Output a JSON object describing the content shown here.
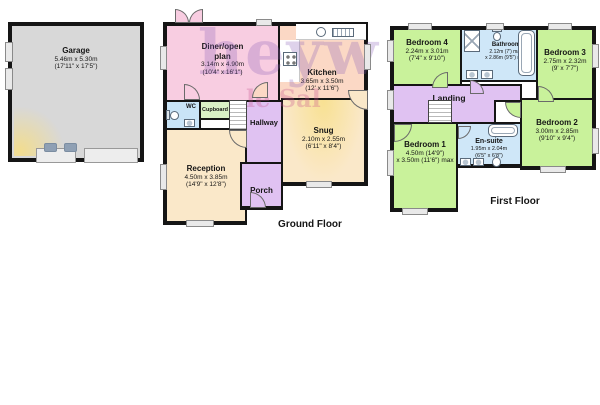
{
  "watermark": {
    "line1": "heyw",
    "line2": "le Sal"
  },
  "colors": {
    "wall": "#151515",
    "pink": "#f8cde1",
    "peach": "#fbd8c5",
    "cream": "#fae8c9",
    "purple": "#e0c2f2",
    "blue": "#cfe7f8",
    "wc_blue": "#c9e4f7",
    "green": "#c9f29b",
    "cupboard_green": "#d9f0c5",
    "garage_gray": "#d8d8d8",
    "watermark_purple": "rgba(138,92,182,0.28)",
    "watermark_pink": "rgba(199,82,143,0.30)"
  },
  "garage": {
    "name": "Garage",
    "dim_m": "5.46m x 5.30m",
    "dim_ft": "(17'11\" x 17'5\")"
  },
  "ground_floor": {
    "label": "Ground Floor",
    "rooms": {
      "diner": {
        "line1": "Diner/open",
        "line2": "plan",
        "dim_m": "3.14m x 4.90m",
        "dim_ft": "(10'4\" x 16'1\")"
      },
      "kitchen": {
        "name": "Kitchen",
        "dim_m": "3.65m x 3.50m",
        "dim_ft": "(12' x 11'6\")"
      },
      "wc": {
        "name": "WC"
      },
      "cupboard": {
        "name": "Cupboard"
      },
      "hallway": {
        "name": "Hallway"
      },
      "snug": {
        "name": "Snug",
        "dim_m": "2.10m x 2.55m",
        "dim_ft": "(6'11\" x 8'4\")"
      },
      "reception": {
        "name": "Reception",
        "dim_m": "4.50m x 3.85m",
        "dim_ft": "(14'9\" x 12'8\")"
      },
      "porch": {
        "name": "Porch"
      }
    }
  },
  "first_floor": {
    "label": "First Floor",
    "rooms": {
      "bedroom4": {
        "name": "Bedroom 4",
        "dim_m": "2.24m x 3.01m",
        "dim_ft": "(7'4\" x 9'10\")"
      },
      "bathroom": {
        "name": "Bathroom",
        "dim1": "2.12m (7') max",
        "dim2": "x 2.86m (9'5\") max"
      },
      "bedroom3": {
        "name": "Bedroom 3",
        "dim_m": "2.75m x 2.32m",
        "dim_ft": "(9' x 7'7\")"
      },
      "landing": {
        "name": "Landing"
      },
      "bedroom1": {
        "name": "Bedroom 1",
        "dim1": "4.50m (14'9\")",
        "dim2": "x 3.50m (11'6\") max"
      },
      "ensuite": {
        "name": "En-suite",
        "dim_m": "1.95m x 2.04m",
        "dim_ft": "(6'5\" x 6'8\")"
      },
      "bedroom2": {
        "name": "Bedroom 2",
        "dim_m": "3.00m x 2.85m",
        "dim_ft": "(9'10\" x 9'4\")"
      }
    }
  }
}
